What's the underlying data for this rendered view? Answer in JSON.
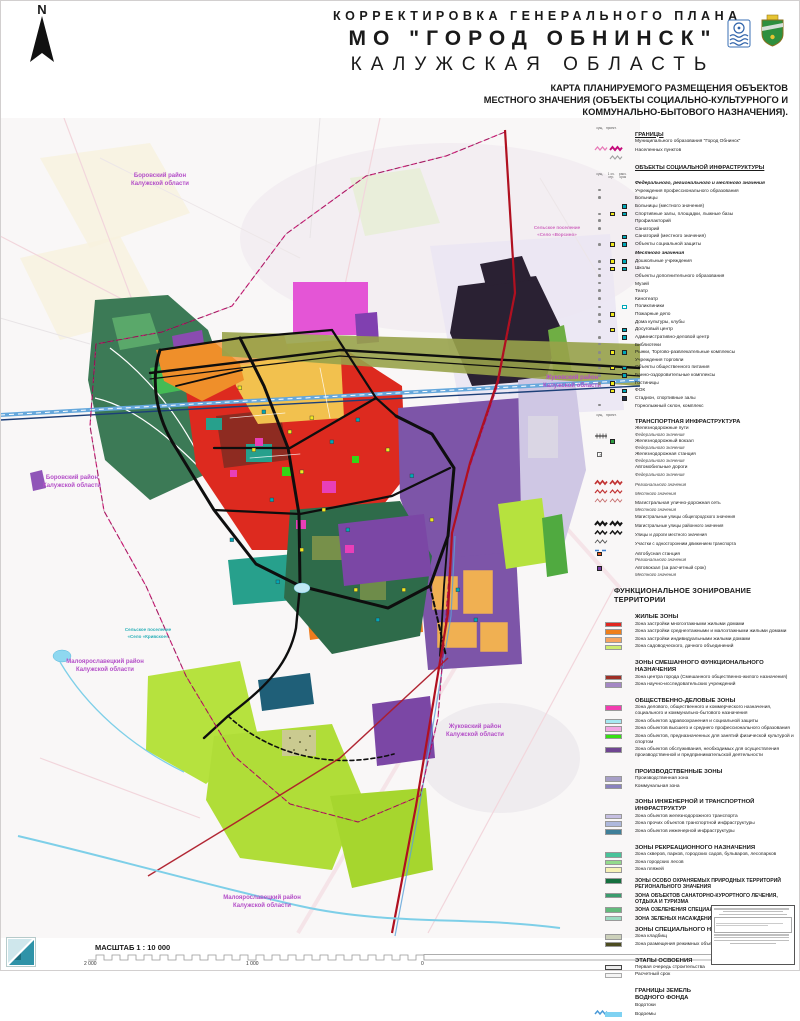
{
  "header": {
    "line1": "КОРРЕКТИРОВКА ГЕНЕРАЛЬНОГО ПЛАНА",
    "line2": "МО \"ГОРОД ОБНИНСК\"",
    "line3": "КАЛУЖСКАЯ ОБЛАСТЬ",
    "sub1": "КАРТА ПЛАНИРУЕМОГО РАЗМЕЩЕНИЯ ОБЪЕКТОВ",
    "sub2": "МЕСТНОГО ЗНАЧЕНИЯ (ОБЪЕКТЫ СОЦИАЛЬНО-КУЛЬТУРНОГО И",
    "sub3": "КОММУНАЛЬНО-БЫТОВОГО НАЗНАЧЕНИЯ)."
  },
  "compass": {
    "label": "N"
  },
  "map": {
    "labels": [
      {
        "a": "Боровский район",
        "b": "Калужской области"
      },
      {
        "a": "Боровский район",
        "b": "Калужской области"
      },
      {
        "a": "Жуковский район",
        "b": "Калужской области"
      },
      {
        "a": "Малоярославецкий район",
        "b": "Калужской области"
      },
      {
        "a": "Жуковский район",
        "b": "Калужской области"
      },
      {
        "a": "Малоярославецкий район",
        "b": "Калужской области"
      }
    ],
    "settlements": [
      {
        "a": "Сельское поселение",
        "b": "«Село «Кривское»"
      },
      {
        "a": "Сельское поселение",
        "b": "«Село «Ворсино»"
      }
    ]
  },
  "legend": {
    "sections": [
      {
        "t": "ГРАНИЦЫ",
        "tc": "und",
        "ch": [
          "сущ.",
          "проект."
        ],
        "items": [
          {
            "la": "Муниципального образования \"Город Обнинск\"",
            "sy": {
              "l": [
                "zmL",
                "zmB"
              ]
            }
          },
          {
            "la": "Населенных пунктов",
            "sy": {
              "l": [
                "",
                "zg"
              ]
            }
          }
        ]
      },
      {
        "t": "ОБЪЕКТЫ СОЦИАЛЬНОЙ ИНФРАСТРУКТУРЫ",
        "tc": "und",
        "gap": 2,
        "chAfter": 1,
        "ch": [
          "сущ.",
          "1 оч. стр.",
          "расч. срок"
        ],
        "items": [
          {
            "la": "Федерального, регионального и местного значения",
            "it": 1
          },
          {
            "la": "Учреждения профессионального образования",
            "sy": {
              "m": [
                "ds",
                "",
                ""
              ]
            }
          },
          {
            "la": "Больницы",
            "sy": {
              "m": [
                "ds",
                "",
                ""
              ]
            }
          },
          {
            "la": "Больницы (местного значения)",
            "sy": {
              "m": [
                "",
                "",
                "t"
              ]
            }
          },
          {
            "la": "Спортивные залы, площадки, лыжные базы",
            "sy": {
              "m": [
                "ds",
                "y",
                "t"
              ]
            }
          },
          {
            "la": "Профилакторий",
            "sy": {
              "m": [
                "ds",
                "",
                ""
              ]
            }
          },
          {
            "la": "Санаторий",
            "sy": {
              "m": [
                "ds",
                "",
                ""
              ]
            }
          },
          {
            "la": "Санаторий (местного значения)",
            "sy": {
              "m": [
                "",
                "",
                "t"
              ]
            }
          },
          {
            "la": "Объекты социальной защиты",
            "sy": {
              "m": [
                "ds",
                "y",
                "t"
              ]
            }
          },
          {
            "la": "Местного значения",
            "it": 1,
            "gap": 1
          },
          {
            "la": "Дошкольные учреждения",
            "sy": {
              "m": [
                "ds",
                "y",
                "t"
              ]
            }
          },
          {
            "la": "Школы",
            "sy": {
              "m": [
                "ds",
                "y",
                "t"
              ]
            }
          },
          {
            "la": "Объекты дополнительного образования",
            "sy": {
              "m": [
                "ds",
                "",
                ""
              ]
            }
          },
          {
            "la": "Музей",
            "sy": {
              "m": [
                "ds",
                "",
                ""
              ]
            }
          },
          {
            "la": "Театр",
            "sy": {
              "m": [
                "ds",
                "",
                ""
              ]
            }
          },
          {
            "la": "Кинотеатр",
            "sy": {
              "m": [
                "ds",
                "",
                ""
              ]
            }
          },
          {
            "la": "Поликлиники",
            "sy": {
              "m": [
                "ds",
                "",
                "to"
              ]
            }
          },
          {
            "la": "Пожарные депо",
            "sy": {
              "m": [
                "ds",
                "y",
                ""
              ]
            }
          },
          {
            "la": "Дома культуры, клубы",
            "sy": {
              "m": [
                "ds",
                "",
                ""
              ]
            }
          },
          {
            "la": "Досуговый центр",
            "sy": {
              "m": [
                "",
                "y",
                "t"
              ]
            }
          },
          {
            "la": "Административно-деловой центр",
            "sy": {
              "m": [
                "ds",
                "",
                "t"
              ]
            }
          },
          {
            "la": "Библиотеки",
            "sy": {
              "m": [
                "ds",
                "",
                ""
              ]
            }
          },
          {
            "la": "Рынки,  Торгово-развлекательные комплексы",
            "sy": {
              "m": [
                "ds",
                "y",
                "t"
              ]
            }
          },
          {
            "la": "Учреждения торговли",
            "sy": {
              "m": [
                "ds",
                "",
                ""
              ]
            }
          },
          {
            "la": "Объекты общественного питания",
            "sy": {
              "m": [
                "ds",
                "y",
                "t"
              ]
            }
          },
          {
            "la": "Банно-оздоровительные комплексы",
            "sy": {
              "m": [
                "ds",
                "",
                "t"
              ]
            }
          },
          {
            "la": "Гостиницы",
            "sy": {
              "m": [
                "ds",
                "y",
                ""
              ]
            }
          },
          {
            "la": "ФОК",
            "sy": {
              "m": [
                "",
                "y",
                "t"
              ]
            }
          },
          {
            "la": "Стадион, спортивные залы",
            "sy": {
              "m": [
                "",
                "",
                "d"
              ]
            }
          },
          {
            "la": "Горнолыжный  склон, комплекс",
            "sy": {
              "m": [
                "ds",
                "",
                ""
              ]
            }
          }
        ]
      },
      {
        "t": "ТРАНСПОРТНАЯ ИНФРАСТРУКТУРА",
        "tc": "bold",
        "gap": 1,
        "ch": [
          "сущ.",
          "проект."
        ],
        "items": [
          {
            "la": "Железнодорожные пути",
            "su": "Федерального значения",
            "sy": {
              "l": [
                "rail"
              ]
            }
          },
          {
            "la": "Железнодорожный вокзал",
            "su": "Федерального значения",
            "sy": {
              "m": [
                "",
                "g",
                ""
              ]
            }
          },
          {
            "la": "Железнодорожная станция",
            "su": "Федерального значения",
            "sy": {
              "m": [
                "x",
                "",
                ""
              ]
            }
          },
          {
            "la": "Автомобильные дороги"
          },
          {
            "su": "Федерального значения",
            "sy": {
              "l": [
                "zr",
                "zr"
              ]
            }
          },
          {
            "su": "Регионального значения",
            "sy": {
              "l": [
                "zrM",
                "zrM"
              ]
            }
          },
          {
            "su": "Местного значения",
            "sy": {
              "l": [
                "zrT",
                "zrT"
              ]
            }
          },
          {
            "la": "Магистральная улично-дорожная сеть",
            "su": "Местного значения",
            "gap": 1
          },
          {
            "la": "Магистральные улицы общегородского значения",
            "sm": 1,
            "sy": {
              "l": [
                "zkB",
                "zkB"
              ]
            }
          },
          {
            "la": "Магистральные улицы районного значения",
            "sm": 1,
            "sy": {
              "l": [
                "zkM",
                "zkM"
              ]
            }
          },
          {
            "la": "Улицы и дороги местного значения",
            "sm": 1,
            "sy": {
              "l": [
                "zkT"
              ]
            }
          },
          {
            "la": "Участки с односторонним движением транспорта",
            "sm": 1,
            "sy": {
              "l": [
                "dsb"
              ]
            }
          },
          {
            "la": "Автобусная станция",
            "su": "Регионального значения",
            "sy": {
              "m": [
                "or",
                "",
                ""
              ]
            },
            "gap": 1
          },
          {
            "la": "Автовокзал (за расчетный срок)",
            "su": "Местного значения",
            "sy": {
              "m": [
                "p",
                "",
                ""
              ]
            },
            "gap": 1
          }
        ]
      },
      {
        "t": "ФУНКЦИОНАЛЬНОЕ ЗОНИРОВАНИЕ ТЕРРИТОРИИ",
        "tc": "big",
        "gap": 2
      },
      {
        "t": "ЖИЛЫЕ ЗОНЫ",
        "tc": "bold",
        "gap": 2,
        "items": [
          {
            "la": "Зона застройки многоэтажными жилыми домами",
            "sy": {
              "c": "#e0261f"
            }
          },
          {
            "la": "Зона застройки среднеэтажными и малоэтажными жилыми домами",
            "sy": {
              "c": "#ef7f1a"
            }
          },
          {
            "la": "Зона застройки индивидуальными жилыми домами",
            "sy": {
              "c": "#f6a45f"
            }
          },
          {
            "la": "Зона садоводческого, дачного объединений",
            "sy": {
              "c": "#cdec6e"
            }
          }
        ]
      },
      {
        "t": "ЗОНЫ СМЕШАННОГО ФУНКЦИОНАЛЬНОГО НАЗНАЧЕНИЯ",
        "tc": "bold",
        "gap": 2,
        "items": [
          {
            "la": "Зона центра города (Смешанного общественно-жилого назначения)",
            "sy": {
              "c": "#9e2f26"
            }
          },
          {
            "la": "Зона научно-исследовательских учреждений",
            "sy": {
              "c": "#a487c4"
            }
          }
        ]
      },
      {
        "t": "ОБЩЕСТВЕННО-ДЕЛОВЫЕ ЗОНЫ",
        "tc": "bold",
        "gap": 2,
        "items": [
          {
            "la": "Зона делового, общественного и коммерческого назначения, социального и коммунально-бытового назначения",
            "sy": {
              "c": "#f23db0"
            }
          },
          {
            "la": "Зона объектов здравоохранения и социальной защиты",
            "sy": {
              "c": "#a5e9f2"
            }
          },
          {
            "la": "Зона объектов высшего и среднего профессионального образования",
            "sy": {
              "c": "#f2a6e3"
            }
          },
          {
            "la": "Зона объектов, предназначенных для занятий физической культурой и спортом",
            "sy": {
              "c": "#35e012"
            }
          },
          {
            "la": "Зона объектов обслуживания, необходимых для осуществления производственной и предпринимательской деятельности",
            "sy": {
              "c": "#6f4591"
            }
          }
        ]
      },
      {
        "t": "ПРОИЗВОДСТВЕННЫЕ ЗОНЫ",
        "tc": "bold",
        "gap": 2,
        "items": [
          {
            "la": "Производственная зона",
            "sy": {
              "c": "#a79fc7"
            }
          },
          {
            "la": "Коммунальная зона",
            "sy": {
              "c": "#8a82bf"
            }
          }
        ]
      },
      {
        "t": "ЗОНЫ ИНЖЕНЕРНОЙ И ТРАНСПОРТНОЙ ИНФРАСТРУКТУР",
        "tc": "bold",
        "gap": 2,
        "items": [
          {
            "la": "Зона объектов железнодорожного транспорта",
            "sy": {
              "c": "#c6bfe2"
            }
          },
          {
            "la": "Зона прочих объектов транспортной инфраструктуры",
            "sy": {
              "c": "#aeb8dc"
            }
          },
          {
            "la": "Зона объектов инженерной инфраструктуры",
            "sy": {
              "c": "#3f7f99"
            }
          }
        ]
      },
      {
        "t": "ЗОНЫ РЕКРЕАЦИОННОГО НАЗНАЧЕНИЯ",
        "tc": "bold",
        "gap": 2,
        "items": [
          {
            "la": "Зона скверов, парков, городских садов, бульваров, лесопарков",
            "sy": {
              "c": "#49c39a"
            }
          },
          {
            "la": "Зона городских лесов",
            "sy": {
              "c": "#93da8c"
            }
          },
          {
            "la": "Зона пляжей",
            "sy": {
              "c": "#f7f2b6"
            }
          }
        ]
      },
      {
        "gap": 1,
        "items": [
          {
            "la": "ЗОНЫ ОСОБО ОХРАНЯЕМЫХ ПРИРОДНЫХ ТЕРРИТОРИЙ РЕГИОНАЛЬНОГО ЗНАЧЕНИЯ",
            "b": 1,
            "sy": {
              "c": "#156f3e",
              "h": 1
            }
          },
          {
            "la": "ЗОНА ОБЪЕКТОВ САНАТОРНО-КУРОРТНОГО ЛЕЧЕНИЯ, ОТДЫХА И ТУРИЗМА",
            "b": 1,
            "sy": {
              "c": "#3a9c6e"
            }
          },
          {
            "la": "ЗОНА ОЗЕЛЕНЕНИЯ СПЕЦИАЛЬНОГО НАЗНАЧЕНИЯ",
            "b": 1,
            "sy": {
              "c": "#63ba7c"
            }
          },
          {
            "la": "ЗОНА ЗЕЛЕНЫХ НАСАЖДЕНИЙ ОБЩЕГО ПОЛЬЗОВАНИЯ",
            "b": 1,
            "sy": {
              "c": "#9cdcc2"
            }
          }
        ]
      },
      {
        "t": "ЗОНЫ СПЕЦИАЛЬНОГО НАЗНАЧЕНИЯ",
        "tc": "bold",
        "items": [
          {
            "la": "Зона кладбищ",
            "sy": {
              "c": "#ccd0ba",
              "h": 1
            }
          },
          {
            "la": "Зона размещения режимных объектов",
            "sy": {
              "c": "#4c4c20"
            }
          }
        ]
      },
      {
        "t": "ЭТАПЫ ОСВОЕНИЯ",
        "tc": "bold",
        "gap": 2,
        "items": [
          {
            "la": "Первая очередь строительства",
            "sy": {
              "c": "#ececec",
              "br": "#444"
            }
          },
          {
            "la": "Расчетный срок",
            "sy": {
              "c": "#f4f4f4",
              "br": "#aaa"
            }
          }
        ]
      },
      {
        "t": "ГРАНИЦЫ ЗЕМЕЛЬ",
        "t2": "ВОДНОГО ФОНДА",
        "tc": "bold",
        "gap": 2,
        "items": [
          {
            "la": "Водотоки",
            "sy": {
              "l": [
                "zb"
              ]
            }
          },
          {
            "la": "Водоемы",
            "sy": {
              "c": "#7fd2f2",
              "br": "#7fd2f2"
            }
          }
        ]
      }
    ]
  },
  "footer": {
    "scale_label": "МАСШТАБ 1 : 10 000",
    "t1": "2 000",
    "t2": "1 000",
    "t3": "0",
    "t4": "2 000",
    "units": "МЕТРЫ"
  }
}
